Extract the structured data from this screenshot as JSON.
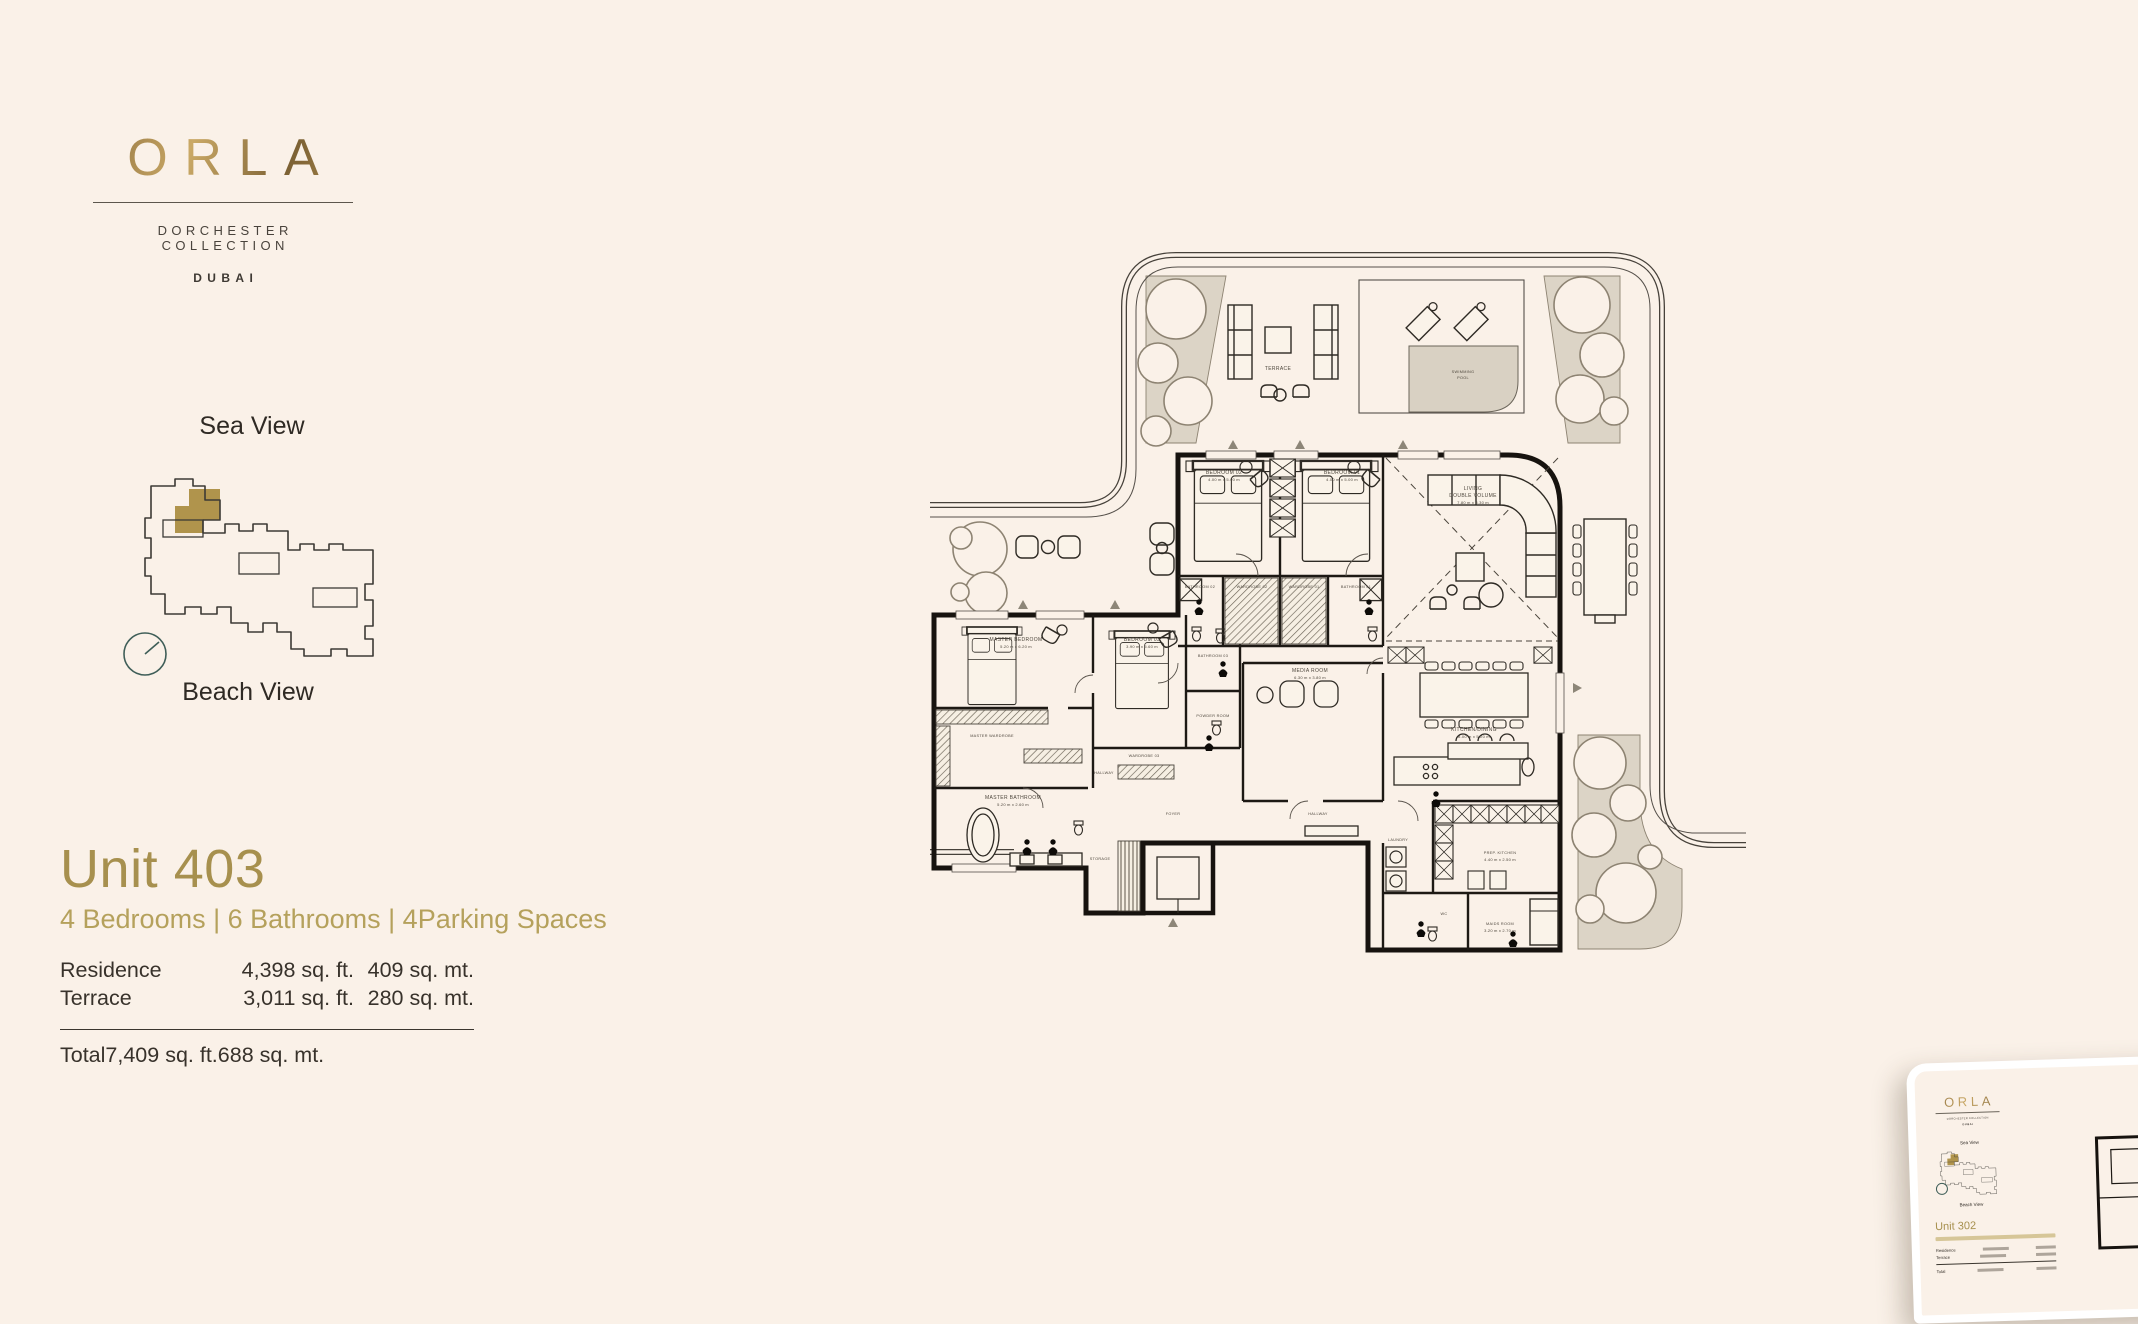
{
  "logo": {
    "brand": "ORLA",
    "collection": "DORCHESTER COLLECTION",
    "city": "DUBAI"
  },
  "keyplan": {
    "sea_view": "Sea View",
    "beach_view": "Beach View",
    "highlight_color": "#B0944C",
    "outline_color": "#3c3a35",
    "compass_color": "#3f5e58"
  },
  "unit": {
    "title": "Unit 403",
    "subtitle": "4 Bedrooms | 6 Bathrooms | 4Parking Spaces",
    "table": {
      "rows": [
        {
          "label": "Residence",
          "sqft": "4,398 sq. ft.",
          "sqmt": "409 sq. mt."
        },
        {
          "label": "Terrace",
          "sqft": "3,011 sq. ft.",
          "sqmt": "280 sq. mt."
        }
      ],
      "total": {
        "label": "Total",
        "sqft": "7,409 sq. ft.",
        "sqmt": "688 sq. mt."
      }
    }
  },
  "floorplan": {
    "terrace": "TERRACE",
    "pool_line1": "SWIMMING",
    "pool_line2": "POOL",
    "rooms": {
      "bedroom02": {
        "name": "BEDROOM 02",
        "dim": "4.00 m x 5.00 m"
      },
      "bedroom01": {
        "name": "BEDROOM 01",
        "dim": "4.00 m x 5.00 m"
      },
      "living_l1": "LIVING",
      "living_l2": "DOUBLE VOLUME",
      "living_dim": "7.80 m x 8.30 m",
      "bathroom02": "BATHROOM 02",
      "wardrobe02": "WARDROBE 02",
      "wardrobe01": "WARDROBE 01",
      "bathroom01": "BATHROOM 01",
      "master_bedroom": {
        "name": "MASTER BEDROOM",
        "dim": "5.20 m x 6.20 m"
      },
      "bedroom03": {
        "name": "BEDROOM 03",
        "dim": "3.90 m x 5.60 m"
      },
      "bathroom03": "BATHROOM 03",
      "powder": "POWDER ROOM",
      "master_wardrobe": "MASTER WARDROBE",
      "wardrobe03": "WARDROBE 03",
      "hallway_a": "HALLWAY",
      "master_bathroom": {
        "name": "MASTER BATHROOM",
        "dim": "5.20 m x 2.60 m"
      },
      "media": {
        "name": "MEDIA ROOM",
        "dim": "6.30 m x 3.80 m"
      },
      "kitchen": {
        "name": "KITCHEN/DINING",
        "dim": "8.00 m x 5.20 m"
      },
      "prep": {
        "name": "PREP. KITCHEN",
        "dim": "4.40 m x 2.50 m"
      },
      "laundry": "LAUNDRY",
      "wc": "WC",
      "maids": {
        "name": "MAIDS ROOM",
        "dim": "3.20 m x 2.70 m"
      },
      "foyer": "FOYER",
      "hallway_b": "HALLWAY",
      "storage": "STORAGE"
    }
  },
  "thumbnail": {
    "brand": "ORLA",
    "collection": "DORCHESTER COLLECTION",
    "city": "DUBAI",
    "sea_view": "Sea View",
    "beach_view": "Beach View",
    "unit_title": "Unit 302",
    "rows": [
      "Residence",
      "Terrace",
      "Total"
    ]
  }
}
